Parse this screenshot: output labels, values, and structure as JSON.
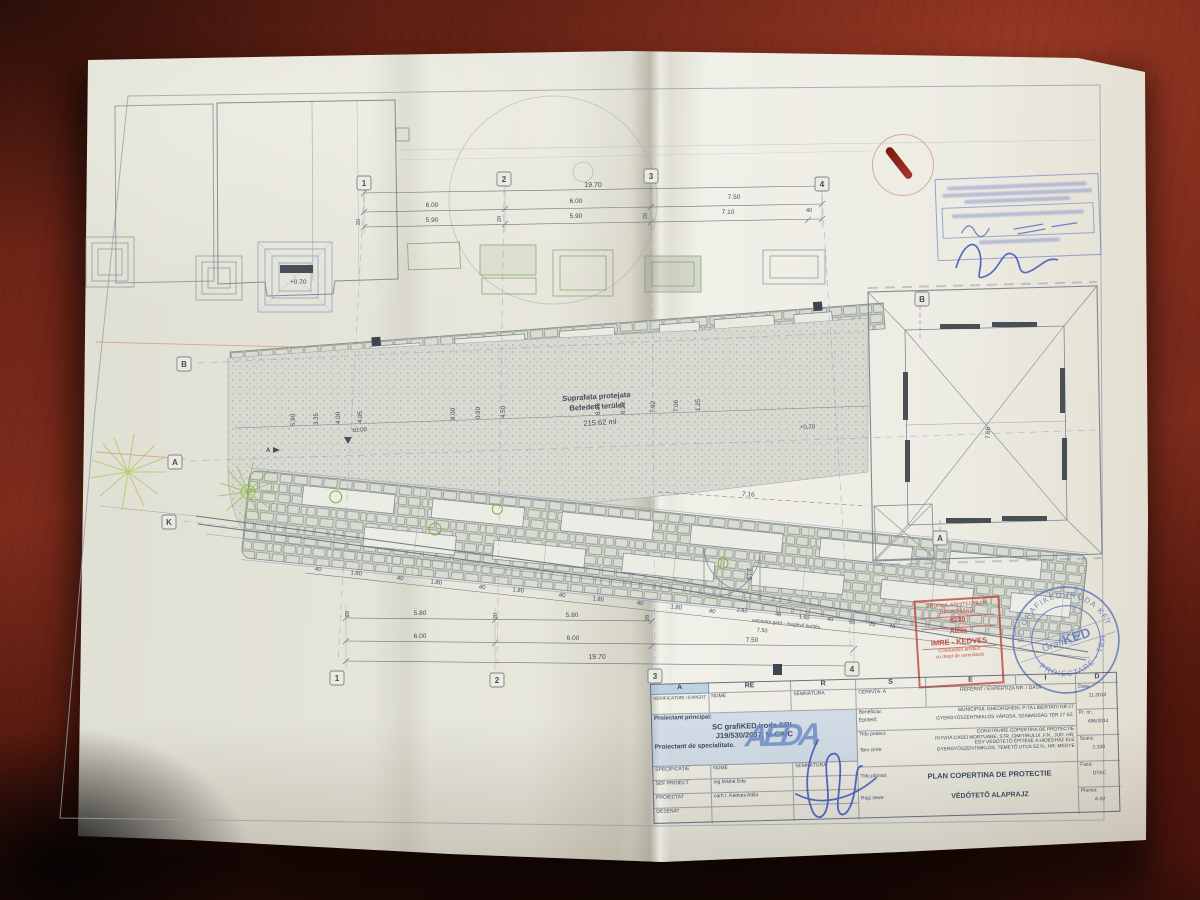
{
  "colors": {
    "table": "#6e2417",
    "paper": "#eae9df",
    "line": "#7e8894",
    "accent_blue": "#7f96c8",
    "accent_green": "#8fae4a",
    "accent_pink": "#c060a8",
    "stamp_red": "#c23f38",
    "stamp_blue": "#5f77bd",
    "ink": "#3b55bb"
  },
  "plan": {
    "grid_top": [
      "1",
      "2",
      "3",
      "4"
    ],
    "grid_bottom": [
      "1",
      "2",
      "3",
      "4"
    ],
    "grid_left": [
      "B",
      "A",
      "K"
    ],
    "grid_right": [
      "B",
      "A"
    ],
    "area_label": {
      "l1": "Suprafata protejata",
      "l2": "Befedett terület",
      "l3": "215.62 ml"
    },
    "levels": {
      "entrance": "+0.70",
      "zero": "±0.00",
      "mid": "+0.20"
    },
    "section_a": "A",
    "dims": {
      "total": "19.70",
      "axis_top": [
        "6.00",
        "6.00",
        "7.50"
      ],
      "axis_top2": [
        "5.90",
        "5.90",
        "7.10"
      ],
      "wall": "40",
      "twenty": "20",
      "bottom_row1": [
        "5.80",
        "5.80"
      ],
      "bottom_row2": [
        "6.00",
        "6.00",
        "7.50"
      ],
      "grave_chain": [
        "40",
        "1.80",
        "40",
        "1.80",
        "40",
        "1.80",
        "40",
        "1.80",
        "40",
        "1.80",
        "40"
      ],
      "pink_chain": [
        "2.62",
        "48",
        "1.50",
        "40",
        "65",
        "25",
        "70"
      ],
      "pink_note": "existenta gard - meglévő kerítés",
      "pink_total": "7.50",
      "mid_ticks": [
        "5.90",
        "3.35",
        "4.00",
        "4.05",
        "8.00",
        "0.90",
        "4.50",
        "8.06",
        "6.32",
        "7.92",
        "7.06",
        "1.25",
        "7.66"
      ],
      "gate_w": "7.16",
      "gate_h": "2.19"
    }
  },
  "stamps": {
    "order": {
      "l1": "ORDINUL ARHITECȚILOR",
      "l2": "DIN ROMÂNIA",
      "number": "6230",
      "name1": "Attila",
      "name2": "IMRE - KEDVES",
      "t1": "Conducător arhitect",
      "t2": "cu drept de semnătură"
    },
    "office": {
      "center1": "Grafi",
      "center2": "KED",
      "ring_top": "SC GRAFIKED IRODA KFT",
      "ring_bottom": "PROIECTARE - TERVEZÉS"
    }
  },
  "title_block": {
    "col_letters": [
      "A",
      "RE",
      "R",
      "S",
      "E",
      "I",
      "D"
    ],
    "verificatori": "VERIFICATORI / EXPERT",
    "nume": "NUME",
    "semnatura": "SEMNĂTURA",
    "cerinta": "CERINȚA: A",
    "referat": "REFERAT / EXPERTIZA NR. / DATA",
    "principal": {
      "l1": "Proiectant principal:",
      "l2": "SC grafiKED iroda SRL,",
      "l3": "J19/530/2007, M-CIUC",
      "l4": "Proiectant de specialitate."
    },
    "logo": "AEDA",
    "specificatie": "SPECIFICAȚIE",
    "rows": [
      {
        "label": "SEF PROIECT",
        "name": "ing Máthé Ede"
      },
      {
        "label": "PROIECTAT",
        "name": "carh I. Kedves Attila"
      },
      {
        "label": "DESENAT",
        "name": ""
      }
    ],
    "beneficiar_label": "Beneficiar:",
    "epitteto_label": "Építtető:",
    "beneficiar": "MUNICIPIUL GHEORGHENI, P-TA LIBERTATII NR 27",
    "epitteto": "GYERGYÓSZENTMIKLÓS VÁROSA, SZABADSÁG TÉR 27 SZ.",
    "titlu_proiect_label": "Titlu proiect:",
    "titlu_proiect1": "CONSTRUIRE COPERTINA DE PROTECTIE",
    "titlu_proiect2": "IN FATA CASEI MORTUARE, STR. CIMITIRULUI, F.N., JUD. HR.",
    "terv_cime_label": "Terv cime:",
    "terv_cime1": "EGY VÉDŐTETŐ ÉPÍTÉSE A HIDEGHÁZ ELÉ",
    "terv_cime2": "GYERGYÓSZENTMIKLÓS, TEMETŐ UTCA SZ.N., HR. MEGYE",
    "titlu_plansa_label": "Titlu plansa:",
    "titlu_plansa": "PLAN COPERTINA DE PROTECTIE",
    "rajz_neve_label": "Rajz neve:",
    "rajz_neve": "VÉDŐTETŐ ALAPRAJZ",
    "meta": [
      {
        "label": "Data:",
        "value": "11.2014"
      },
      {
        "label": "Pr. nr.:",
        "value": "496/2014"
      },
      {
        "label": "Scara:",
        "value": "1:100"
      },
      {
        "label": "Faza:",
        "value": "DTAC"
      },
      {
        "label": "Plansa:",
        "value": "A-02"
      }
    ]
  }
}
